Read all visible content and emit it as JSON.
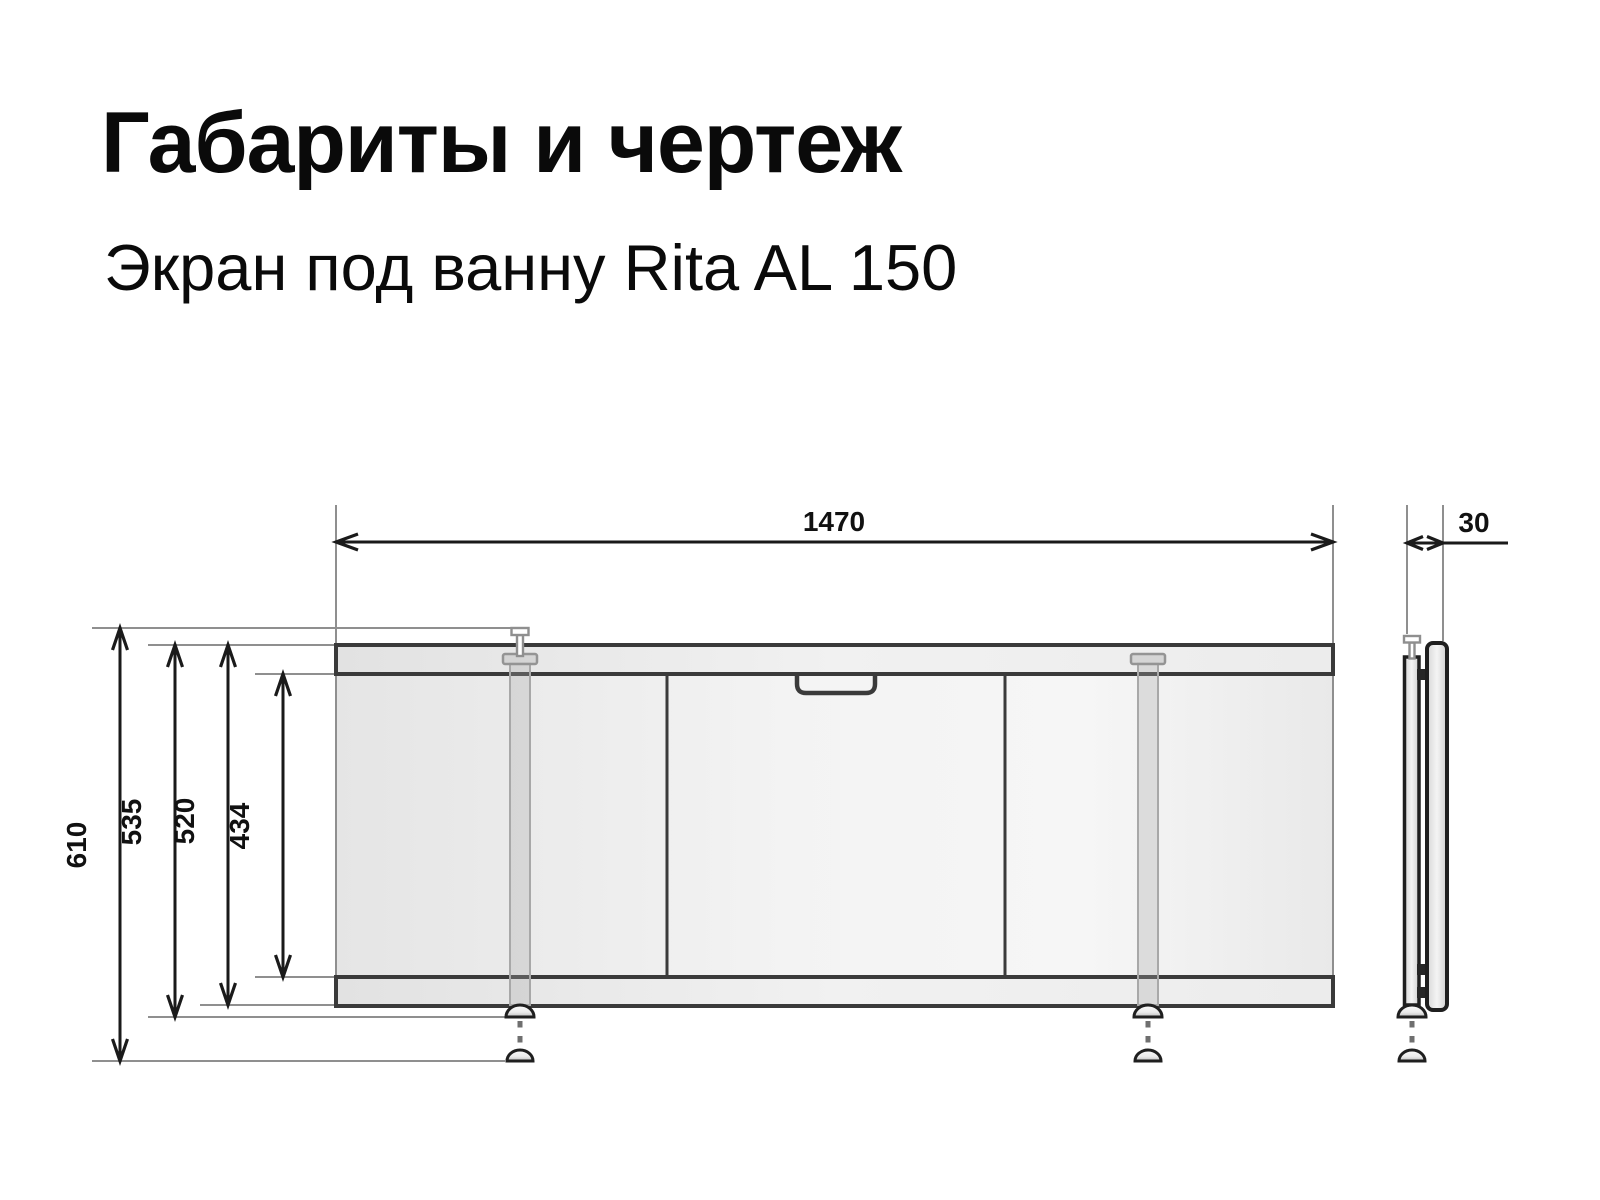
{
  "page": {
    "title": "Габариты и чертеж",
    "subtitle": "Экран под ванну Rita AL 150"
  },
  "drawing": {
    "product": "Rita AL 150",
    "dimensions": {
      "overall_width": "1470",
      "max_height_feet_extended": "610",
      "height_with_feet": "535",
      "panel_height": "520",
      "inner_opening_height": "434",
      "profile_depth": "30"
    },
    "colors": {
      "background": "#ffffff",
      "text": "#0a0a0a",
      "panel_outline": "#3a3a3a",
      "dimension_line": "#1a1a1a",
      "extension_line": "#8f8f8f",
      "panel_fill_light": "#f5f5f5",
      "panel_fill_dark": "#e4e4e4"
    }
  }
}
